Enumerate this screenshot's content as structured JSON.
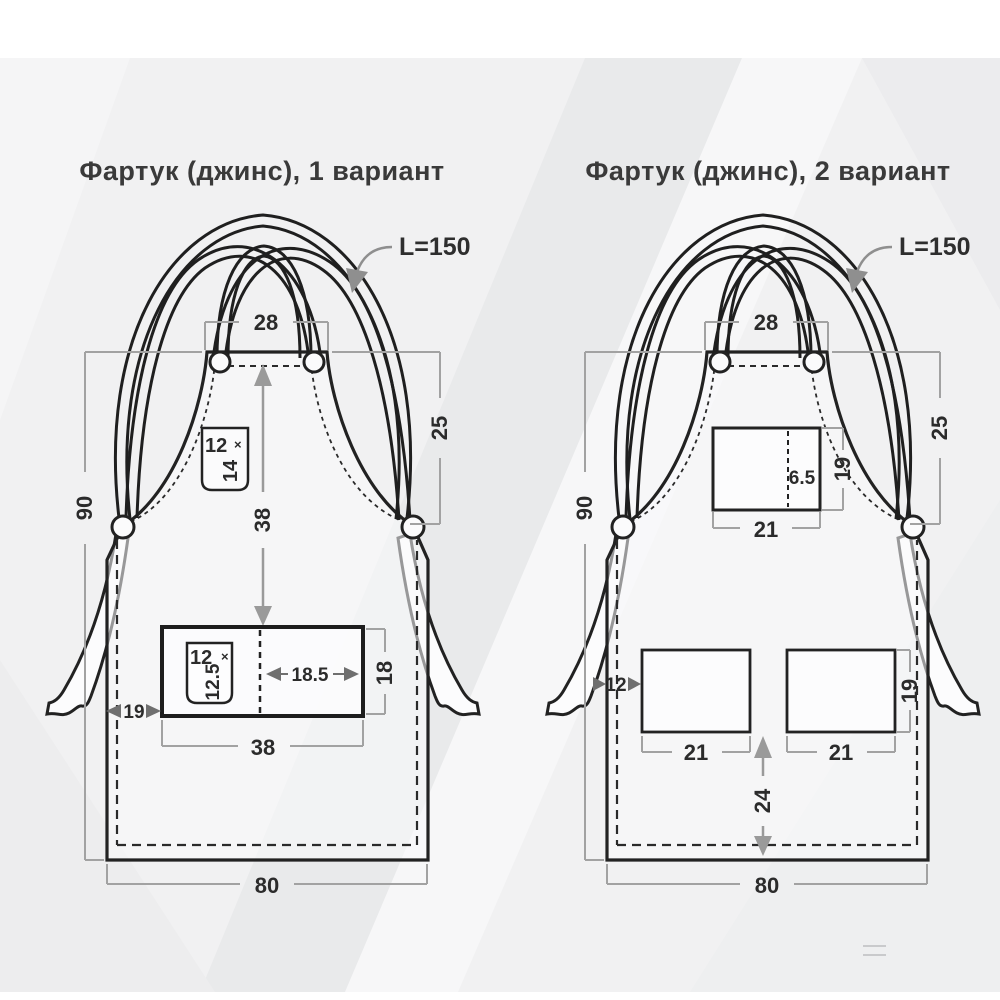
{
  "variant1": {
    "title": "Фартук (джинс), 1 вариант",
    "strap_length": "L=150",
    "dims": {
      "top_width": "28",
      "total_height": "90",
      "bib_side_drop": "25",
      "bib_to_pocket": "38",
      "pocket_width": "38",
      "pocket_height": "18",
      "pocket_center_to_edge": "18.5",
      "pocket_offset_left": "19",
      "bottom_width": "80"
    },
    "chest_pocket": {
      "width": "12",
      "times": "×",
      "height": "14"
    },
    "pen_pocket": {
      "width": "12",
      "times": "×",
      "height": "12.5"
    }
  },
  "variant2": {
    "title": "Фартук (джинс), 2 вариант",
    "strap_length": "L=150",
    "dims": {
      "top_width": "28",
      "total_height": "90",
      "bib_side_drop": "25",
      "chest_pocket_width": "21",
      "chest_pocket_height": "19",
      "chest_pocket_divider": "6.5",
      "left_pocket_width": "21",
      "right_pocket_width": "21",
      "pocket_height": "19",
      "pocket_offset_left": "12",
      "pockets_to_bottom": "24",
      "bottom_width": "80"
    }
  }
}
